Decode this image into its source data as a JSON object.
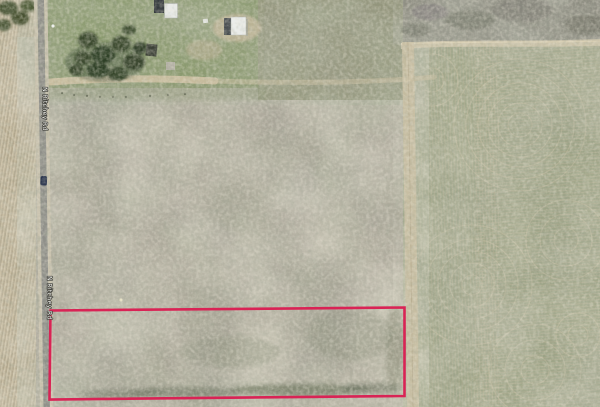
{
  "map": {
    "road": {
      "name": "N Ritchey Rd",
      "labels": [
        {
          "text": "N Ritchey Rd"
        },
        {
          "text": "N Ritchey Rd"
        }
      ]
    },
    "parcel": {
      "outline_color": "#d92355"
    },
    "palette": {
      "field_main": "#a8a396",
      "field_right": "#9aa183",
      "field_left": "#b4a98f",
      "yard_green": "#87976a",
      "scrub_olive": "#8e9075",
      "road_asphalt": "#8f8f89",
      "road_shoulder": "#c8c1ad",
      "track_tan": "#c9bfa3",
      "tree_green": "#3a4a2e",
      "building_white": "#e9ebe9",
      "building_dark": "#35393d",
      "vehicle_blue": "#25304a"
    }
  }
}
